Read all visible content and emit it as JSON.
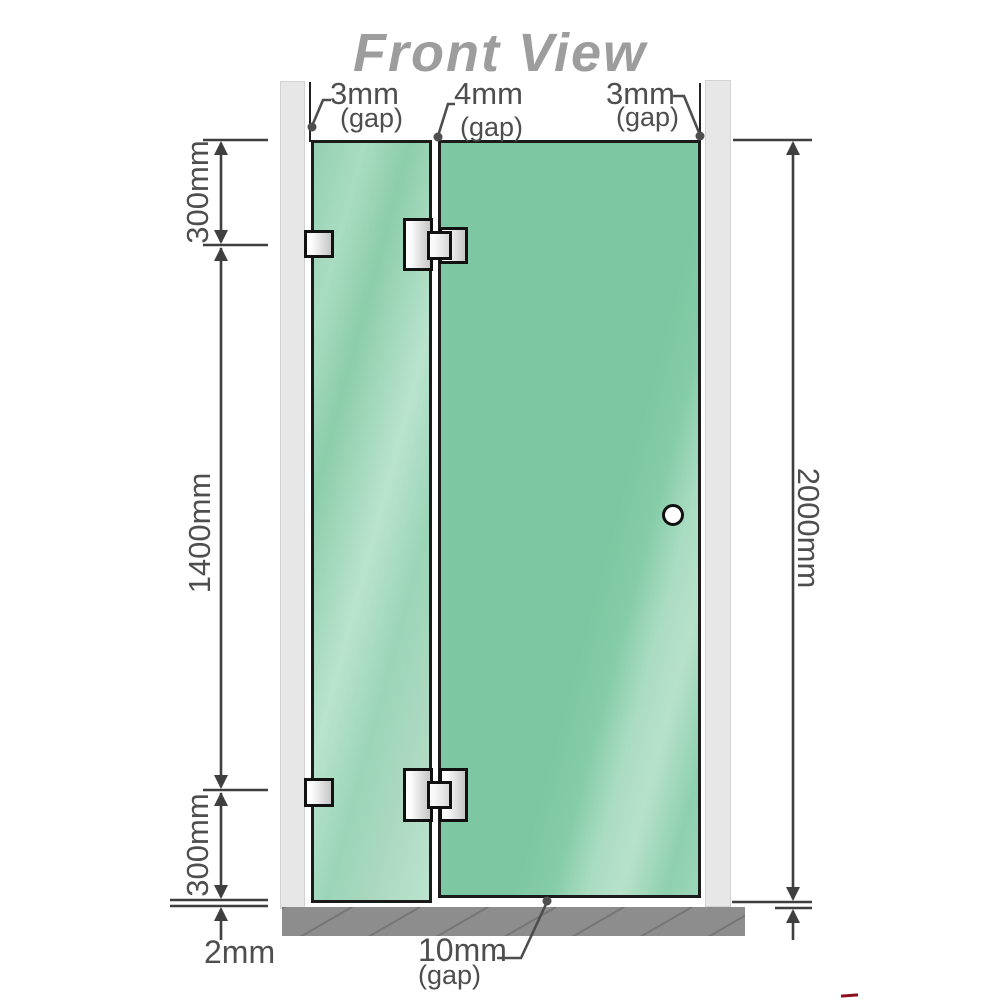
{
  "title": "Front View",
  "annotations": {
    "top_left_gap": {
      "value": "3mm",
      "note": "(gap)"
    },
    "top_middle_gap": {
      "value": "4mm",
      "note": "(gap)"
    },
    "top_right_gap": {
      "value": "3mm",
      "note": "(gap)"
    },
    "left_upper": "300mm",
    "left_middle": "1400mm",
    "left_lower": "300mm",
    "bottom_floor_gap": "2mm",
    "bottom_door_gap": {
      "value": "10mm",
      "note": "(gap)"
    },
    "right_total_height": "2000mm"
  },
  "colors": {
    "door_glass": "#7dc8a2",
    "fixed_glass": "#a5d9bd",
    "glass_border": "#1b1b1b",
    "wall": "#e7e7e7",
    "floor": "#8d8d8d",
    "title_gray": "#9d9d9d",
    "dimension_gray": "#4e4e4e",
    "corner_mark_red": "#8a1022"
  }
}
